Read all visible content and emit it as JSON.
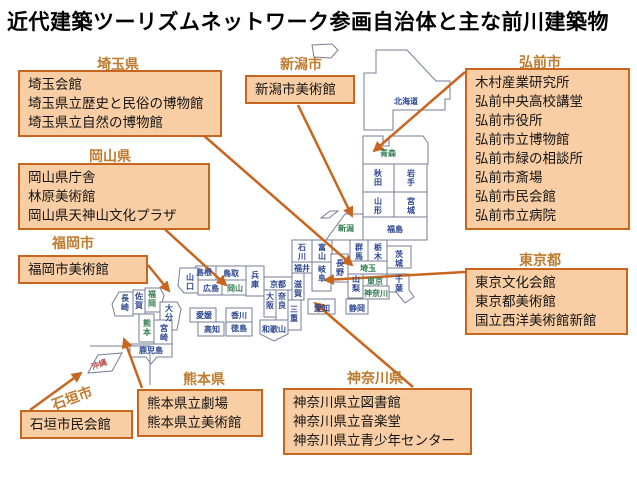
{
  "title": "近代建築ツーリズムネットワーク参画自治体と主な前川建築物",
  "colors": {
    "callout_fill": "#F9CEA4",
    "callout_border": "#C8651F",
    "callout_title": "#BF7B2E",
    "arrow": "#C8651F",
    "map_outline": "#757E95",
    "prefecture_normal": "#2B4590",
    "prefecture_member": "#317A4F",
    "okinawa_label": "#C0504D"
  },
  "callouts": {
    "hirosaki": {
      "title": "弘前市",
      "items": [
        "木村産業研究所",
        "弘前中央高校講堂",
        "弘前市役所",
        "弘前市立博物館",
        "弘前市緑の相談所",
        "弘前市斎場",
        "弘前市民会館",
        "弘前市立病院"
      ]
    },
    "niigata": {
      "title": "新潟市",
      "items": [
        "新潟市美術館"
      ]
    },
    "saitama": {
      "title": "埼玉県",
      "items": [
        "埼玉会館",
        "埼玉県立歴史と民俗の博物館",
        "埼玉県立自然の博物館"
      ]
    },
    "okayama": {
      "title": "岡山県",
      "items": [
        "岡山県庁舎",
        "林原美術館",
        "岡山県天神山文化プラザ"
      ]
    },
    "fukuoka": {
      "title": "福岡市",
      "items": [
        "福岡市美術館"
      ]
    },
    "tokyo": {
      "title": "東京都",
      "items": [
        "東京文化会館",
        "東京都美術館",
        "国立西洋美術館新館"
      ]
    },
    "kanagawa": {
      "title": "神奈川県",
      "items": [
        "神奈川県立図書館",
        "神奈川県立音楽堂",
        "神奈川県立青少年センター"
      ]
    },
    "kumamoto": {
      "title": "熊本県",
      "items": [
        "熊本県立劇場",
        "熊本県立美術館"
      ]
    },
    "ishigaki": {
      "title": "石垣市",
      "items": [
        "石垣市民会館"
      ]
    }
  },
  "map": {
    "prefectures": [
      {
        "id": "hokkaido",
        "n": "北海道",
        "x": 406,
        "y": 104,
        "o": "h",
        "s": "n"
      },
      {
        "id": "aomori",
        "n": "青森",
        "x": 388,
        "y": 156,
        "o": "h",
        "s": "g"
      },
      {
        "id": "akita",
        "n": "秋田",
        "x": 378,
        "y": 176,
        "o": "v",
        "s": "n"
      },
      {
        "id": "iwate",
        "n": "岩手",
        "x": 411,
        "y": 176,
        "o": "v",
        "s": "n"
      },
      {
        "id": "yamagata",
        "n": "山形",
        "x": 378,
        "y": 204,
        "o": "v",
        "s": "n"
      },
      {
        "id": "miyagi",
        "n": "宮城",
        "x": 411,
        "y": 204,
        "o": "v",
        "s": "n"
      },
      {
        "id": "fukushima",
        "n": "福島",
        "x": 395,
        "y": 232,
        "o": "h",
        "s": "n"
      },
      {
        "id": "niigata",
        "n": "新潟",
        "x": 346,
        "y": 231,
        "o": "h",
        "s": "g"
      },
      {
        "id": "gunma",
        "n": "群馬",
        "x": 359,
        "y": 250,
        "o": "v",
        "s": "n"
      },
      {
        "id": "tochigi",
        "n": "栃木",
        "x": 378,
        "y": 250,
        "o": "v",
        "s": "n"
      },
      {
        "id": "ibaraki",
        "n": "茨城",
        "x": 399,
        "y": 257,
        "o": "v",
        "s": "n"
      },
      {
        "id": "saitama",
        "n": "埼玉",
        "x": 368,
        "y": 271,
        "o": "h",
        "s": "g"
      },
      {
        "id": "nagano",
        "n": "長野",
        "x": 340,
        "y": 266,
        "o": "v",
        "s": "n"
      },
      {
        "id": "yamanashi",
        "n": "山梨",
        "x": 356,
        "y": 282,
        "o": "v",
        "s": "n"
      },
      {
        "id": "tokyo",
        "n": "東京",
        "x": 375,
        "y": 284,
        "o": "h",
        "s": "g"
      },
      {
        "id": "chiba",
        "n": "千葉",
        "x": 399,
        "y": 282,
        "o": "v",
        "s": "n"
      },
      {
        "id": "kanagawa",
        "n": "神奈川",
        "x": 376,
        "y": 296,
        "o": "h",
        "s": "g",
        "size": 7
      },
      {
        "id": "shizuoka",
        "n": "静岡",
        "x": 357,
        "y": 311,
        "o": "h",
        "s": "n"
      },
      {
        "id": "aichi",
        "n": "愛知",
        "x": 322,
        "y": 311,
        "o": "h",
        "s": "n"
      },
      {
        "id": "ishikawa",
        "n": "石川",
        "x": 302,
        "y": 250,
        "o": "v",
        "s": "n"
      },
      {
        "id": "toyama",
        "n": "富山",
        "x": 322,
        "y": 250,
        "o": "v",
        "s": "n"
      },
      {
        "id": "fukui",
        "n": "福井",
        "x": 302,
        "y": 271,
        "o": "h",
        "s": "n"
      },
      {
        "id": "gifu",
        "n": "岐阜",
        "x": 322,
        "y": 272,
        "o": "v",
        "s": "n"
      },
      {
        "id": "shiga",
        "n": "滋賀",
        "x": 298,
        "y": 287,
        "o": "v",
        "s": "n"
      },
      {
        "id": "kyoto",
        "n": "京都",
        "x": 278,
        "y": 287,
        "o": "h",
        "s": "n"
      },
      {
        "id": "hyogo",
        "n": "兵庫",
        "x": 255,
        "y": 278,
        "o": "v",
        "s": "n"
      },
      {
        "id": "osaka",
        "n": "大阪",
        "x": 270,
        "y": 299,
        "o": "v",
        "s": "n"
      },
      {
        "id": "nara",
        "n": "奈良",
        "x": 282,
        "y": 299,
        "o": "v",
        "s": "n"
      },
      {
        "id": "mie",
        "n": "三重",
        "x": 294,
        "y": 312,
        "o": "v",
        "s": "n"
      },
      {
        "id": "wakayama",
        "n": "和歌山",
        "x": 274,
        "y": 332,
        "o": "h",
        "s": "n",
        "size": 7.5
      },
      {
        "id": "tottori",
        "n": "鳥取",
        "x": 231,
        "y": 276,
        "o": "h",
        "s": "n"
      },
      {
        "id": "shimane",
        "n": "島根",
        "x": 204,
        "y": 275,
        "o": "h",
        "s": "n"
      },
      {
        "id": "yamaguchi",
        "n": "山口",
        "x": 190,
        "y": 280,
        "o": "v",
        "s": "n"
      },
      {
        "id": "hiroshima",
        "n": "広島",
        "x": 211,
        "y": 291,
        "o": "h",
        "s": "n"
      },
      {
        "id": "okayama",
        "n": "岡山",
        "x": 235,
        "y": 291,
        "o": "h",
        "s": "g"
      },
      {
        "id": "ehime",
        "n": "愛媛",
        "x": 204,
        "y": 318,
        "o": "h",
        "s": "n"
      },
      {
        "id": "kagawa",
        "n": "香川",
        "x": 239,
        "y": 318,
        "o": "h",
        "s": "n"
      },
      {
        "id": "kochi",
        "n": "高知",
        "x": 212,
        "y": 332,
        "o": "h",
        "s": "n"
      },
      {
        "id": "tokushima",
        "n": "徳島",
        "x": 239,
        "y": 331,
        "o": "h",
        "s": "n"
      },
      {
        "id": "fukuoka",
        "n": "福岡",
        "x": 152,
        "y": 297,
        "o": "v",
        "s": "g"
      },
      {
        "id": "saga",
        "n": "佐賀",
        "x": 139,
        "y": 299,
        "o": "v",
        "s": "n"
      },
      {
        "id": "nagasaki",
        "n": "長崎",
        "x": 125,
        "y": 301,
        "o": "v",
        "s": "n"
      },
      {
        "id": "oita",
        "n": "大分",
        "x": 169,
        "y": 311,
        "o": "v",
        "s": "n"
      },
      {
        "id": "kumamoto",
        "n": "熊本",
        "x": 147,
        "y": 326,
        "o": "v",
        "s": "g"
      },
      {
        "id": "miyazaki",
        "n": "宮崎",
        "x": 164,
        "y": 331,
        "o": "v",
        "s": "n"
      },
      {
        "id": "kagoshima",
        "n": "鹿児島",
        "x": 151,
        "y": 353,
        "o": "h",
        "s": "n",
        "size": 7
      },
      {
        "id": "okinawa",
        "n": "沖縄",
        "x": 100,
        "y": 367,
        "o": "h",
        "s": "o",
        "size": 7.5,
        "rotate": -20
      }
    ]
  }
}
